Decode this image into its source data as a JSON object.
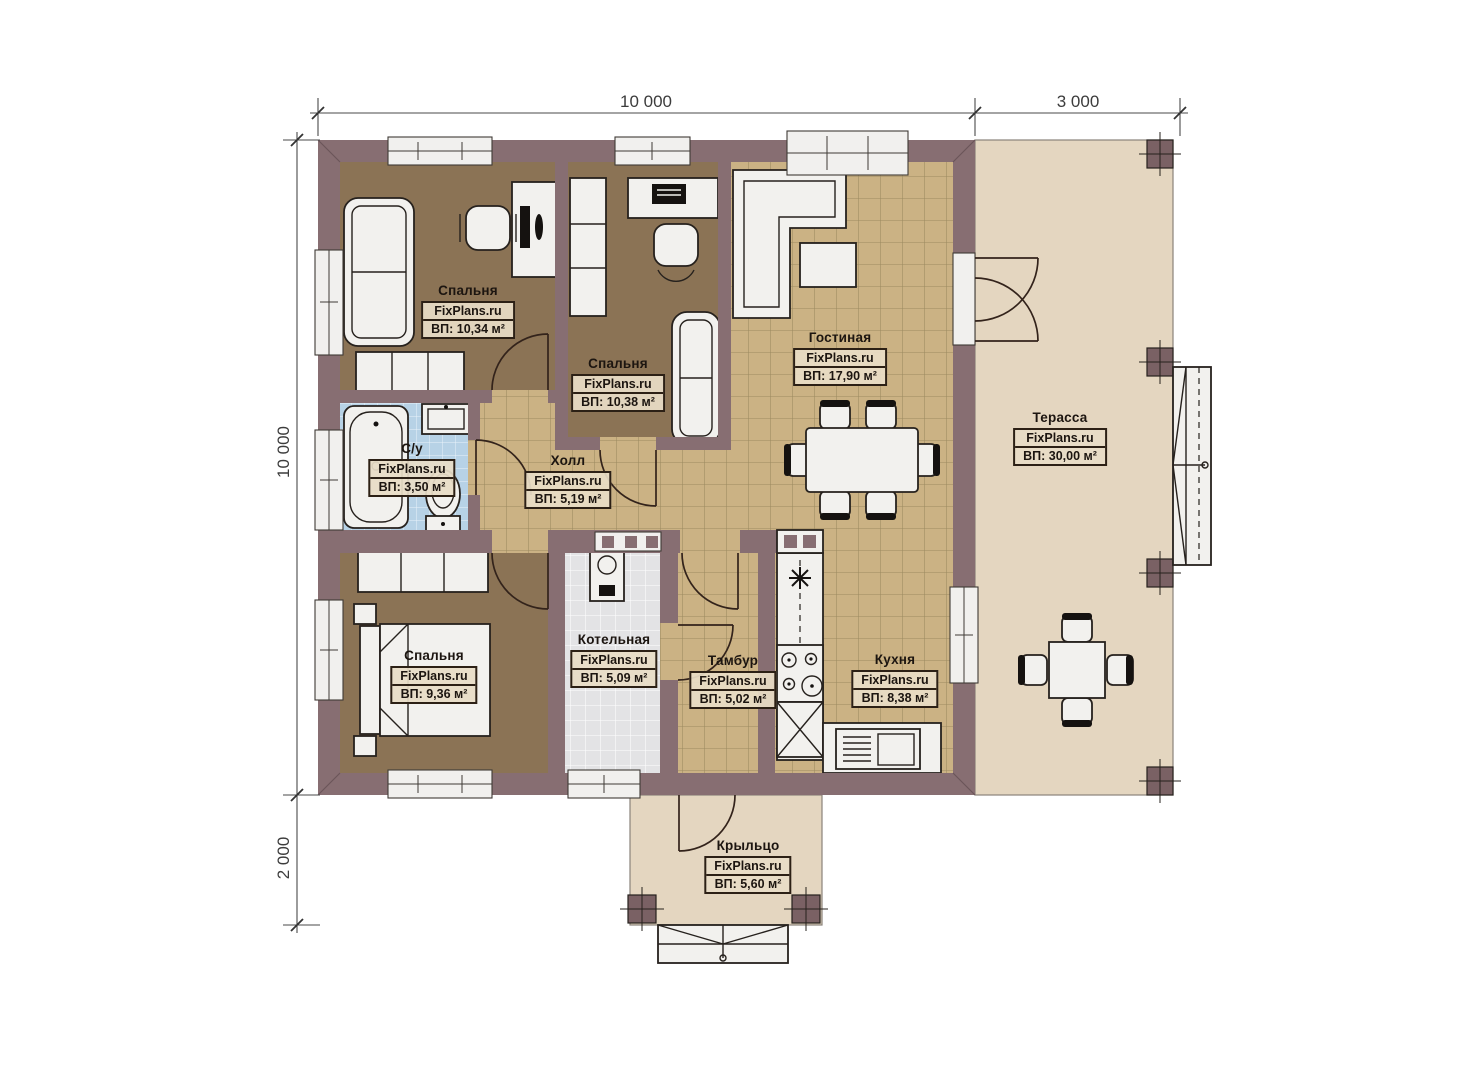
{
  "watermark": "FixPlans.ru",
  "dimensions": {
    "top": [
      {
        "label": "10 000"
      },
      {
        "label": "3 000"
      }
    ],
    "left": [
      {
        "label": "10 000"
      },
      {
        "label": "2 000"
      }
    ]
  },
  "rooms": [
    {
      "id": "bedroom-1",
      "name": "Спальня",
      "site": "FixPlans.ru",
      "area": "ВП: 10,34 м²"
    },
    {
      "id": "bedroom-2",
      "name": "Спальня",
      "site": "FixPlans.ru",
      "area": "ВП: 10,38 м²"
    },
    {
      "id": "living-room",
      "name": "Гостиная",
      "site": "FixPlans.ru",
      "area": "ВП: 17,90 м²"
    },
    {
      "id": "terrace",
      "name": "Терасса",
      "site": "FixPlans.ru",
      "area": "ВП: 30,00 м²"
    },
    {
      "id": "bathroom",
      "name": "С/у",
      "site": "FixPlans.ru",
      "area": "ВП: 3,50 м²"
    },
    {
      "id": "hall",
      "name": "Холл",
      "site": "FixPlans.ru",
      "area": "ВП: 5,19 м²"
    },
    {
      "id": "bedroom-3",
      "name": "Спальня",
      "site": "FixPlans.ru",
      "area": "ВП: 9,36 м²"
    },
    {
      "id": "boiler-room",
      "name": "Котельная",
      "site": "FixPlans.ru",
      "area": "ВП: 5,09 м²"
    },
    {
      "id": "vestibule",
      "name": "Тамбур",
      "site": "FixPlans.ru",
      "area": "ВП: 5,02 м²"
    },
    {
      "id": "kitchen",
      "name": "Кухня",
      "site": "FixPlans.ru",
      "area": "ВП: 8,38 м²"
    },
    {
      "id": "porch",
      "name": "Крыльцо",
      "site": "FixPlans.ru",
      "area": "ВП: 5,60 м²"
    }
  ],
  "colors": {
    "wall": "#876e72",
    "wood_floor": "#8b7355",
    "tile_floor": "#cbb284",
    "tile_line": "#9c8a60",
    "bathroom_tile": "#b7d2e6",
    "boiler_tile": "#e3e3e5",
    "outdoor_floor": "#e4d6c0",
    "post": "#7a6164",
    "furniture": "#f2f1ee",
    "label_bg": "rgba(232,221,198,0.93)"
  }
}
